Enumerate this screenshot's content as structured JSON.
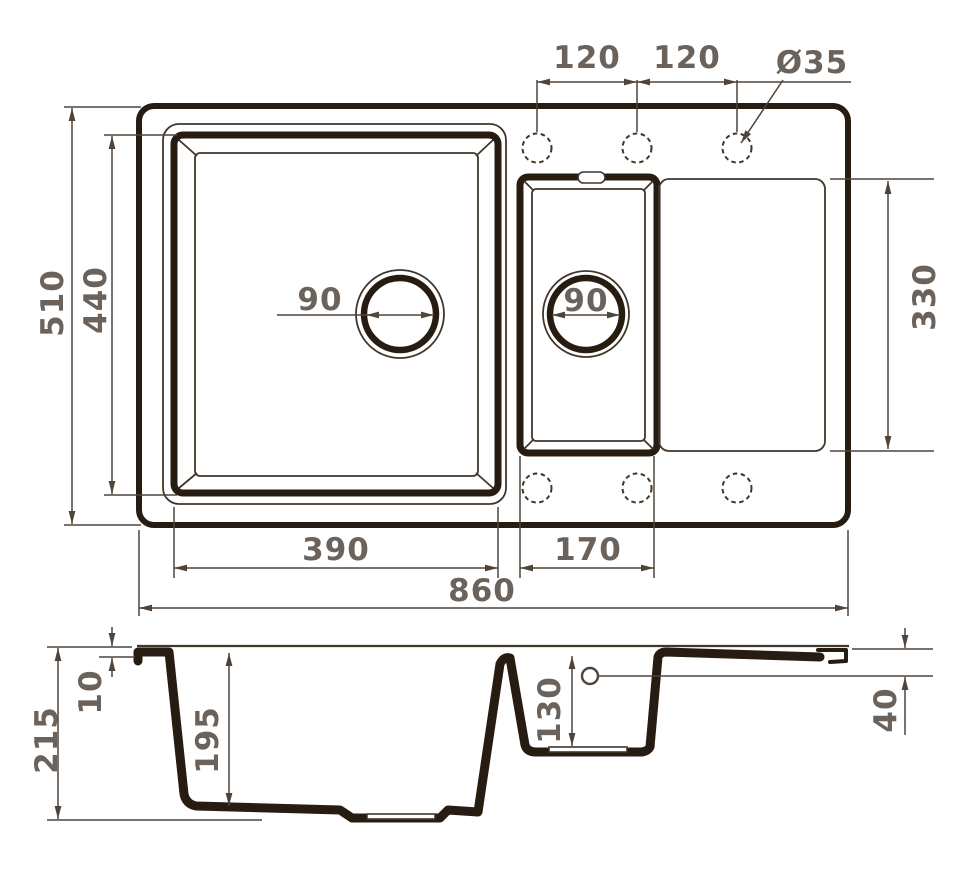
{
  "drawing": {
    "title": "double-bowl kitchen sink dimension drawing",
    "views": [
      "top-view",
      "front-section-view"
    ]
  },
  "colors": {
    "background": "#ffffff",
    "outline_dark": "#271c11",
    "outline_thin": "#41362a",
    "dimension_line": "#4e443a",
    "label_text": "#6b635b"
  },
  "top_view": {
    "dims": {
      "overall_width": "860",
      "overall_depth": "510",
      "main_bowl_width": "390",
      "main_bowl_depth": "440",
      "half_bowl_width": "170",
      "half_bowl_depth": "330",
      "faucet_spacing_left": "120",
      "faucet_spacing_right": "120",
      "faucet_hole_diameter": "Ø35",
      "main_drain_diameter": "90",
      "half_bowl_drain_diameter": "90"
    }
  },
  "side_view": {
    "dims": {
      "overall_height": "215",
      "rim_height": "10",
      "main_bowl_depth": "195",
      "half_bowl_depth": "130",
      "edge_height": "40"
    }
  }
}
